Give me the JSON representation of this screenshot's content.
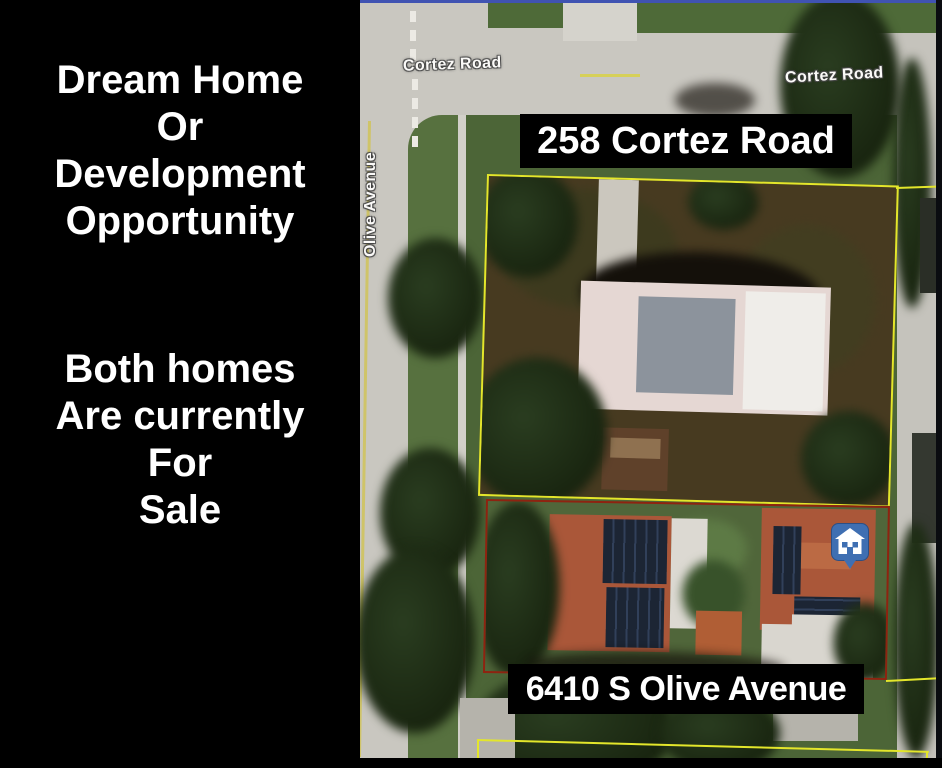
{
  "left_panel": {
    "headline": "Dream Home\nOr\nDevelopment\nOpportunity",
    "tagline": "Both homes\nAre currently\nFor\nSale"
  },
  "map": {
    "labels": {
      "street_top_left": "Cortez Road",
      "street_top_right": "Cortez Road",
      "street_left_vertical": "Olive Avenue"
    },
    "properties": {
      "upper": {
        "address": "258 Cortez Road",
        "outline_color": "#e3e62b"
      },
      "lower": {
        "address": "6410 S Olive Avenue",
        "outline_color": "#8e2310"
      }
    },
    "marker": {
      "icon": "house-marker-icon",
      "color": "#3f6fb2"
    }
  },
  "colors": {
    "page_bg": "#000000",
    "panel_text": "#ffffff",
    "map_border_top": "#4053b2",
    "label_box_bg": "#000000",
    "label_box_text": "#ffffff",
    "parcel_yellow": "#e3e62b",
    "parcel_red": "#8e2310",
    "marker_blue": "#3f6fb2"
  }
}
